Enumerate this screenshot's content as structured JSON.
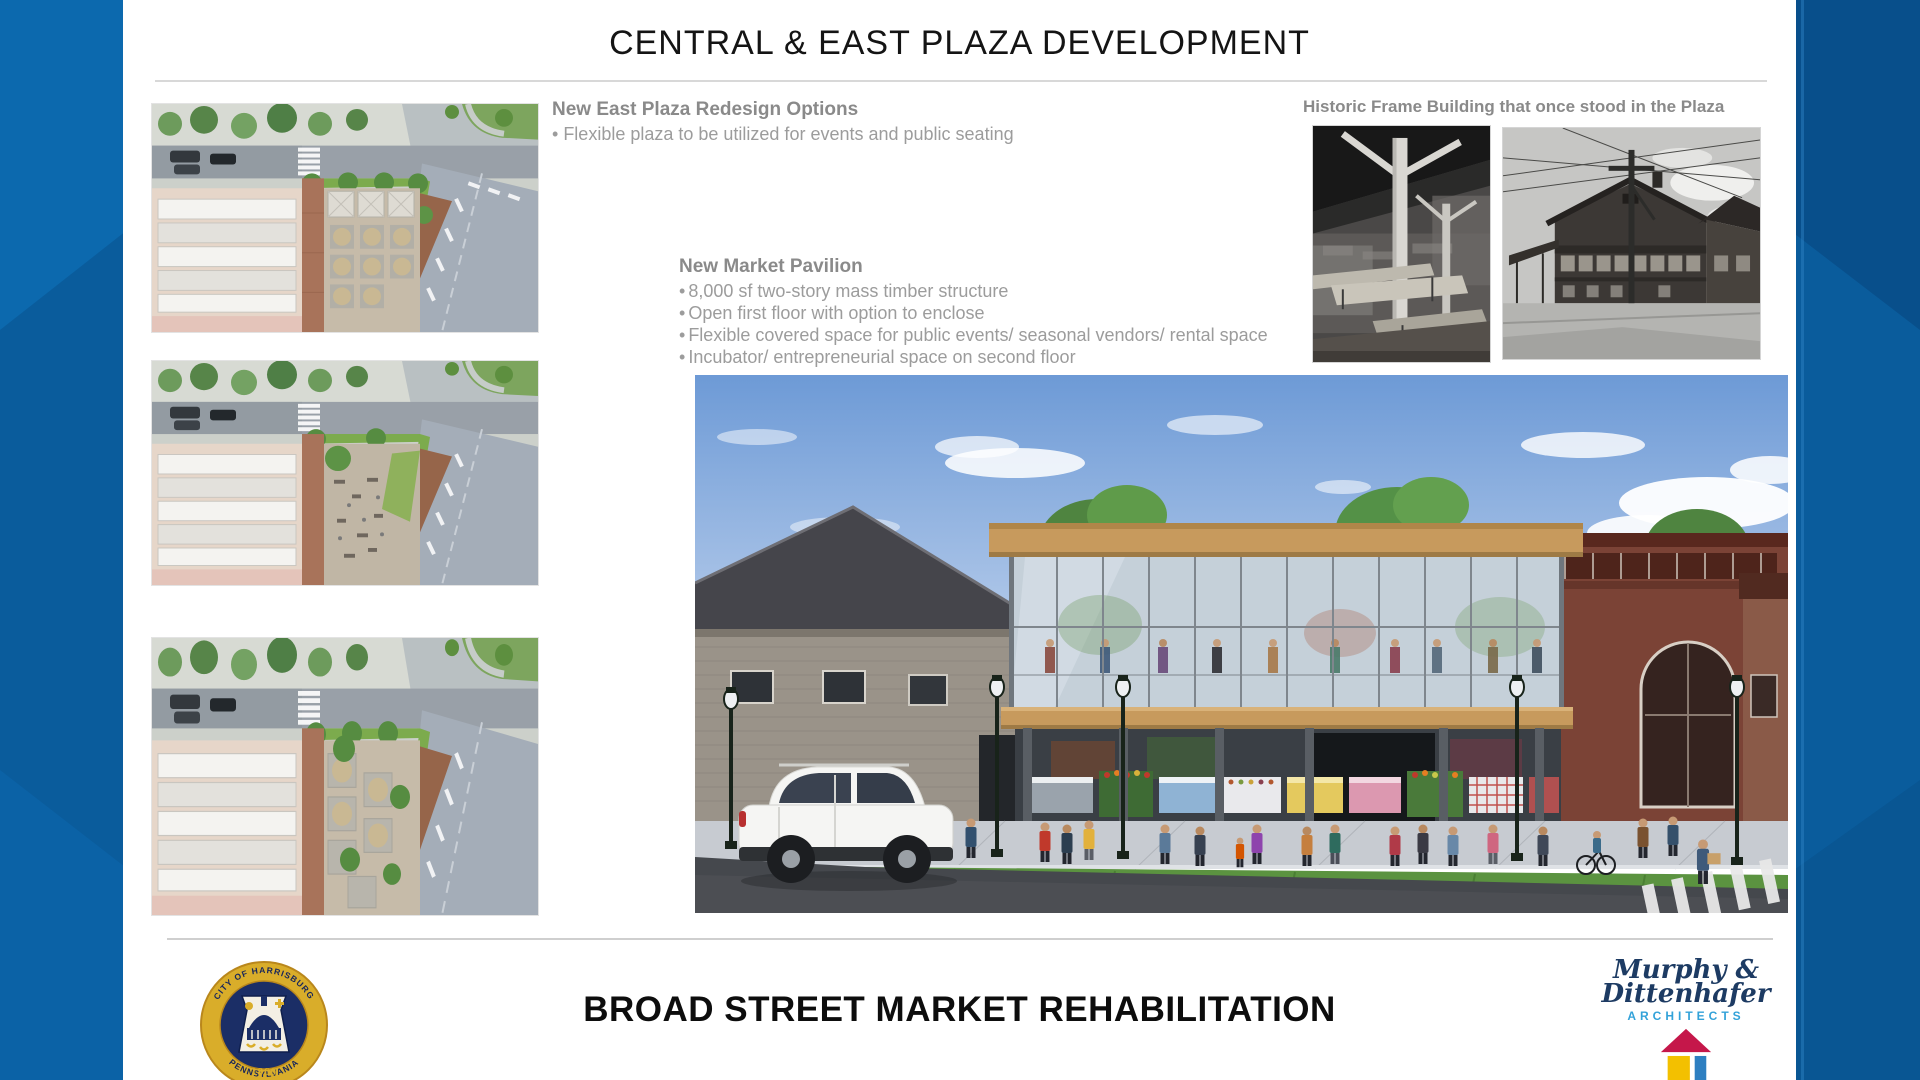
{
  "slide": {
    "title": "CENTRAL & EAST PLAZA DEVELOPMENT",
    "east_plaza": {
      "heading": "New East Plaza Redesign Options",
      "bullets": [
        "Flexible plaza to be utilized for events and public seating"
      ]
    },
    "pavilion": {
      "heading": "New Market Pavilion",
      "bullets": [
        "8,000 sf two-story mass timber structure",
        "Open first floor with option to enclose",
        "Flexible covered space for public events/ seasonal vendors/ rental space",
        "Incubator/ entrepreneurial space on second floor"
      ]
    },
    "historic": {
      "heading": "Historic Frame Building that once stood in the Plaza"
    },
    "footer": {
      "title": "BROAD STREET MARKET REHABILITATION",
      "seal": {
        "arc_top": "CITY OF HARRISBURG",
        "arc_bottom": "PENNSYLVANIA",
        "year": "1860"
      },
      "architect": {
        "line1": "Murphy &",
        "line2": "Dittenhafer",
        "line3": "ARCHITECTS"
      }
    }
  },
  "colors": {
    "background_blue": "#0a5c9c",
    "slide_white": "#ffffff",
    "heading_gray": "#8a8a8a",
    "body_gray": "#9c9c9c",
    "title_black": "#141414",
    "seal_gold": "#d9ad2a",
    "seal_navy": "#1b2e66",
    "architect_navy": "#1d3b63",
    "architect_light_blue": "#33a2d9",
    "house_red": "#c5174a",
    "house_yellow": "#f3c000",
    "house_blue": "#2d7fc1"
  }
}
